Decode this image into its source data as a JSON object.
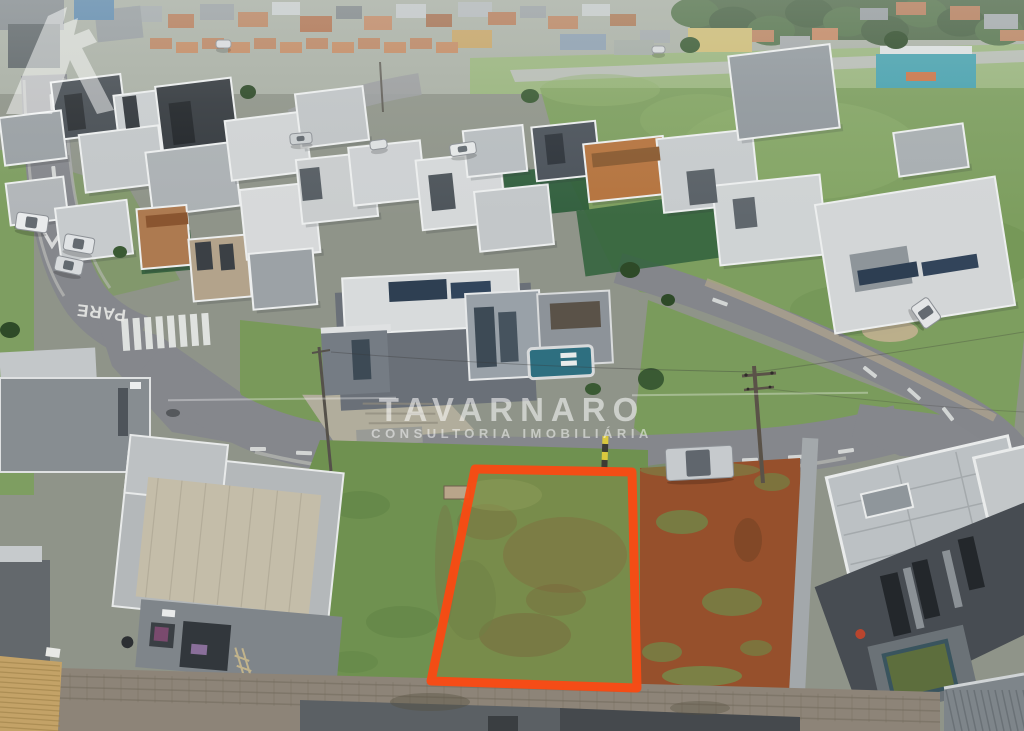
{
  "meta": {
    "type": "aerial-drone-photograph",
    "scene": "overcast aerial view of a modern residential condominium; a vacant grass lot in the foreground is outlined in orange as the advertised property; streets, parked cars, houses under construction, red-earth lot and distant town on the horizon"
  },
  "watermark": {
    "brand": "TAVARNARO",
    "tagline": "CONSULTORIA IMOBILIÁRIA",
    "icon": "rook-tower-icon",
    "color": "#ffffff"
  },
  "road_marking": {
    "stop_text": "PARE"
  },
  "highlight": {
    "lot_outline_color": "#fb4a12"
  },
  "palette": {
    "grass": "#6f9150",
    "field": "#7d9e5f",
    "asphalt": "#85878c",
    "red_dirt": "#96502c",
    "house_light": "#d0d3d4",
    "house_dark": "#474c52",
    "pool_water": "#2e6f80",
    "wall_block": "#8d8478",
    "tile_roof": "#c3a267"
  }
}
